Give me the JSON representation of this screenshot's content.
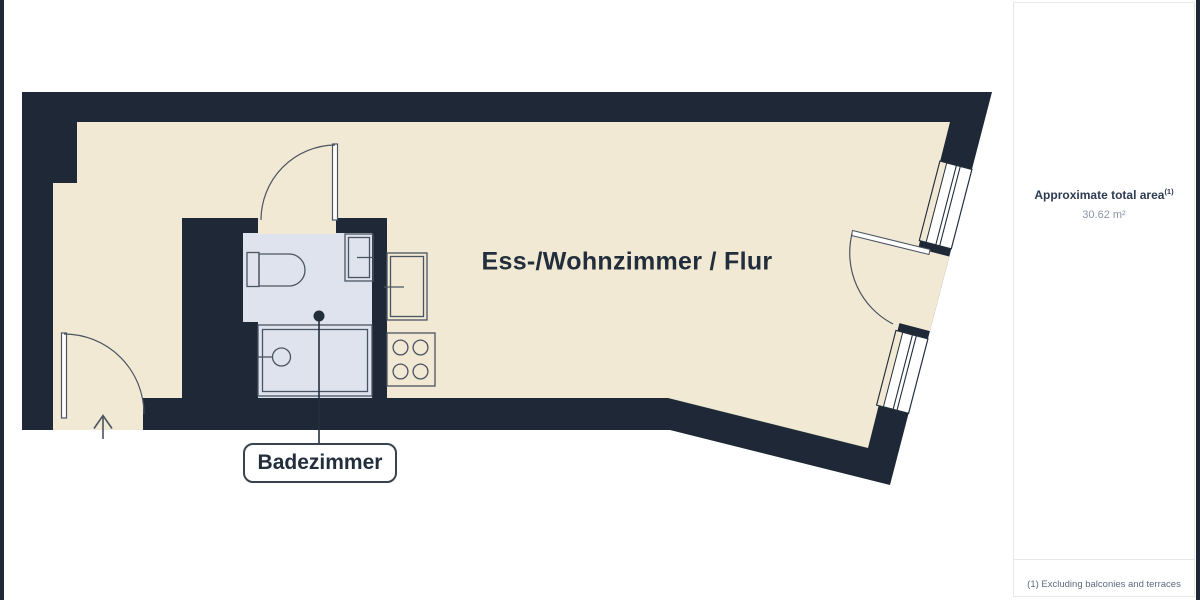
{
  "plan": {
    "rooms": [
      {
        "name": "living-dining-hall",
        "label": "Ess-/Wohnzimmer / Flur"
      },
      {
        "name": "bathroom",
        "label": "Badezimmer"
      }
    ],
    "icons": {
      "entrance": "arrow-up",
      "fixtures": [
        "toilet",
        "bathroom-sink",
        "shower",
        "kitchen-sink",
        "stove-4-burners"
      ]
    }
  },
  "sidebar": {
    "title": "Approximate total area",
    "title_sup": "(1)",
    "area_value": "30.62 m²",
    "footnote": "(1) Excluding balconies and terraces"
  },
  "colors": {
    "wall": "#1e2836",
    "floor": "#f1e9d3",
    "bathfloor": "#dfe3ee",
    "fix": "#4b5462",
    "line-dark": "#232e3c",
    "sidebar-title": "#2c3a52",
    "muted": "#8d95a5",
    "footnote": "#5d6a7e",
    "panel-border": "#e6e8eb"
  }
}
